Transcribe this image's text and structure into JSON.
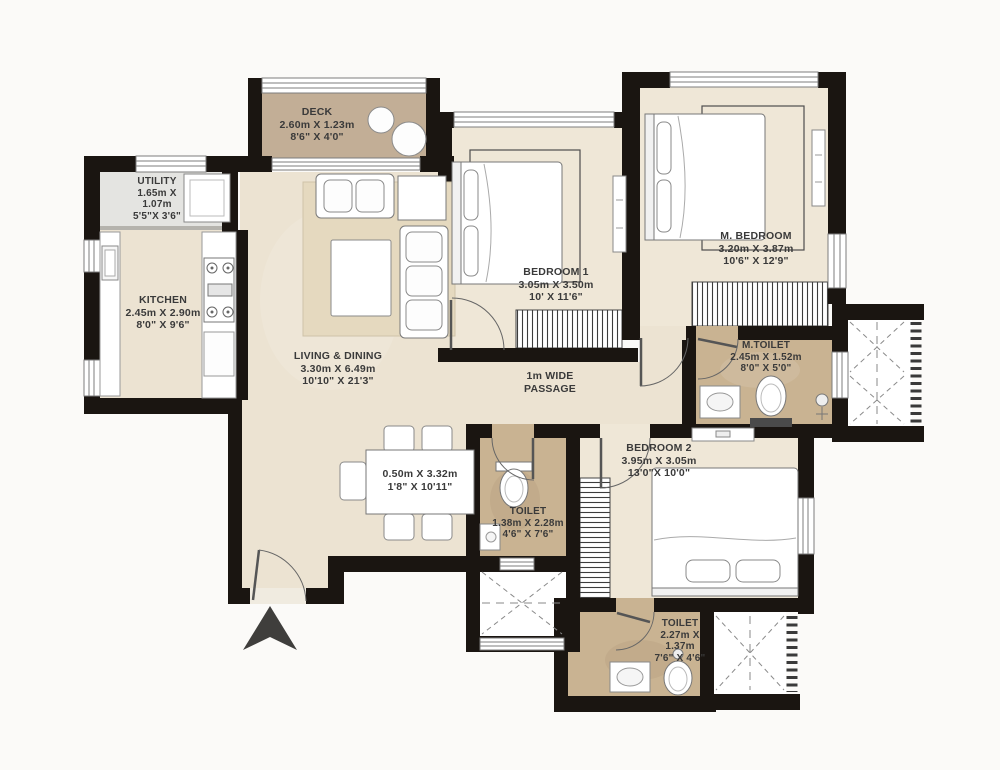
{
  "plan_type": "apartment-floor-plan",
  "colors": {
    "wall": "#1a1511",
    "room_floor": "#ece3d2",
    "deck_floor": "#c2ae96",
    "toilet_floor": "#c9b392",
    "utility_floor": "#e4e4e1",
    "label_text": "#3a3a3a",
    "furniture_fill": "#ffffff",
    "entrance_arrow": "#3f3e3c"
  },
  "rooms": {
    "deck": {
      "name": "DECK",
      "dim_m": "2.60m X 1.23m",
      "dim_ft": "8'6\" X 4'0\""
    },
    "utility": {
      "name": "UTILITY",
      "dim_m_line1": "1.65m X",
      "dim_m_line2": "1.07m",
      "dim_ft": "5'5\"X 3'6\""
    },
    "kitchen": {
      "name": "KITCHEN",
      "dim_m": "2.45m X 2.90m",
      "dim_ft": "8'0\" X 9'6\""
    },
    "living_dining": {
      "name": "LIVING & DINING",
      "dim_m": "3.30m X 6.49m",
      "dim_ft": "10'10\" X 21'3\""
    },
    "bedroom1": {
      "name": "BEDROOM 1",
      "dim_m": "3.05m X 3.50m",
      "dim_ft": "10' X 11'6\""
    },
    "master_bedroom": {
      "name": "M. BEDROOM",
      "dim_m": "3.20m X 3.87m",
      "dim_ft": "10'6\" X 12'9\""
    },
    "master_toilet": {
      "name": "M.TOILET",
      "dim_m": "2.45m X 1.52m",
      "dim_ft": "8'0\" X 5'0\""
    },
    "bedroom2": {
      "name": "BEDROOM 2",
      "dim_m": "3.95m X 3.05m",
      "dim_ft": "13'0\"X 10'0\""
    },
    "common_toilet": {
      "name": "TOILET",
      "dim_m": "1.38m X 2.28m",
      "dim_ft": "4'6\" X 7'6\""
    },
    "second_toilet": {
      "name": "TOILET",
      "dim_m_line1": "2.27m X",
      "dim_m_line2": "1.37m",
      "dim_ft": "7'6\" X 4'6\""
    },
    "passage": {
      "name_line1": "1m WIDE",
      "name_line2": "PASSAGE"
    },
    "dining_table": {
      "dim_m": "0.50m X 3.32m",
      "dim_ft": "1'8\" X 10'11\""
    }
  }
}
